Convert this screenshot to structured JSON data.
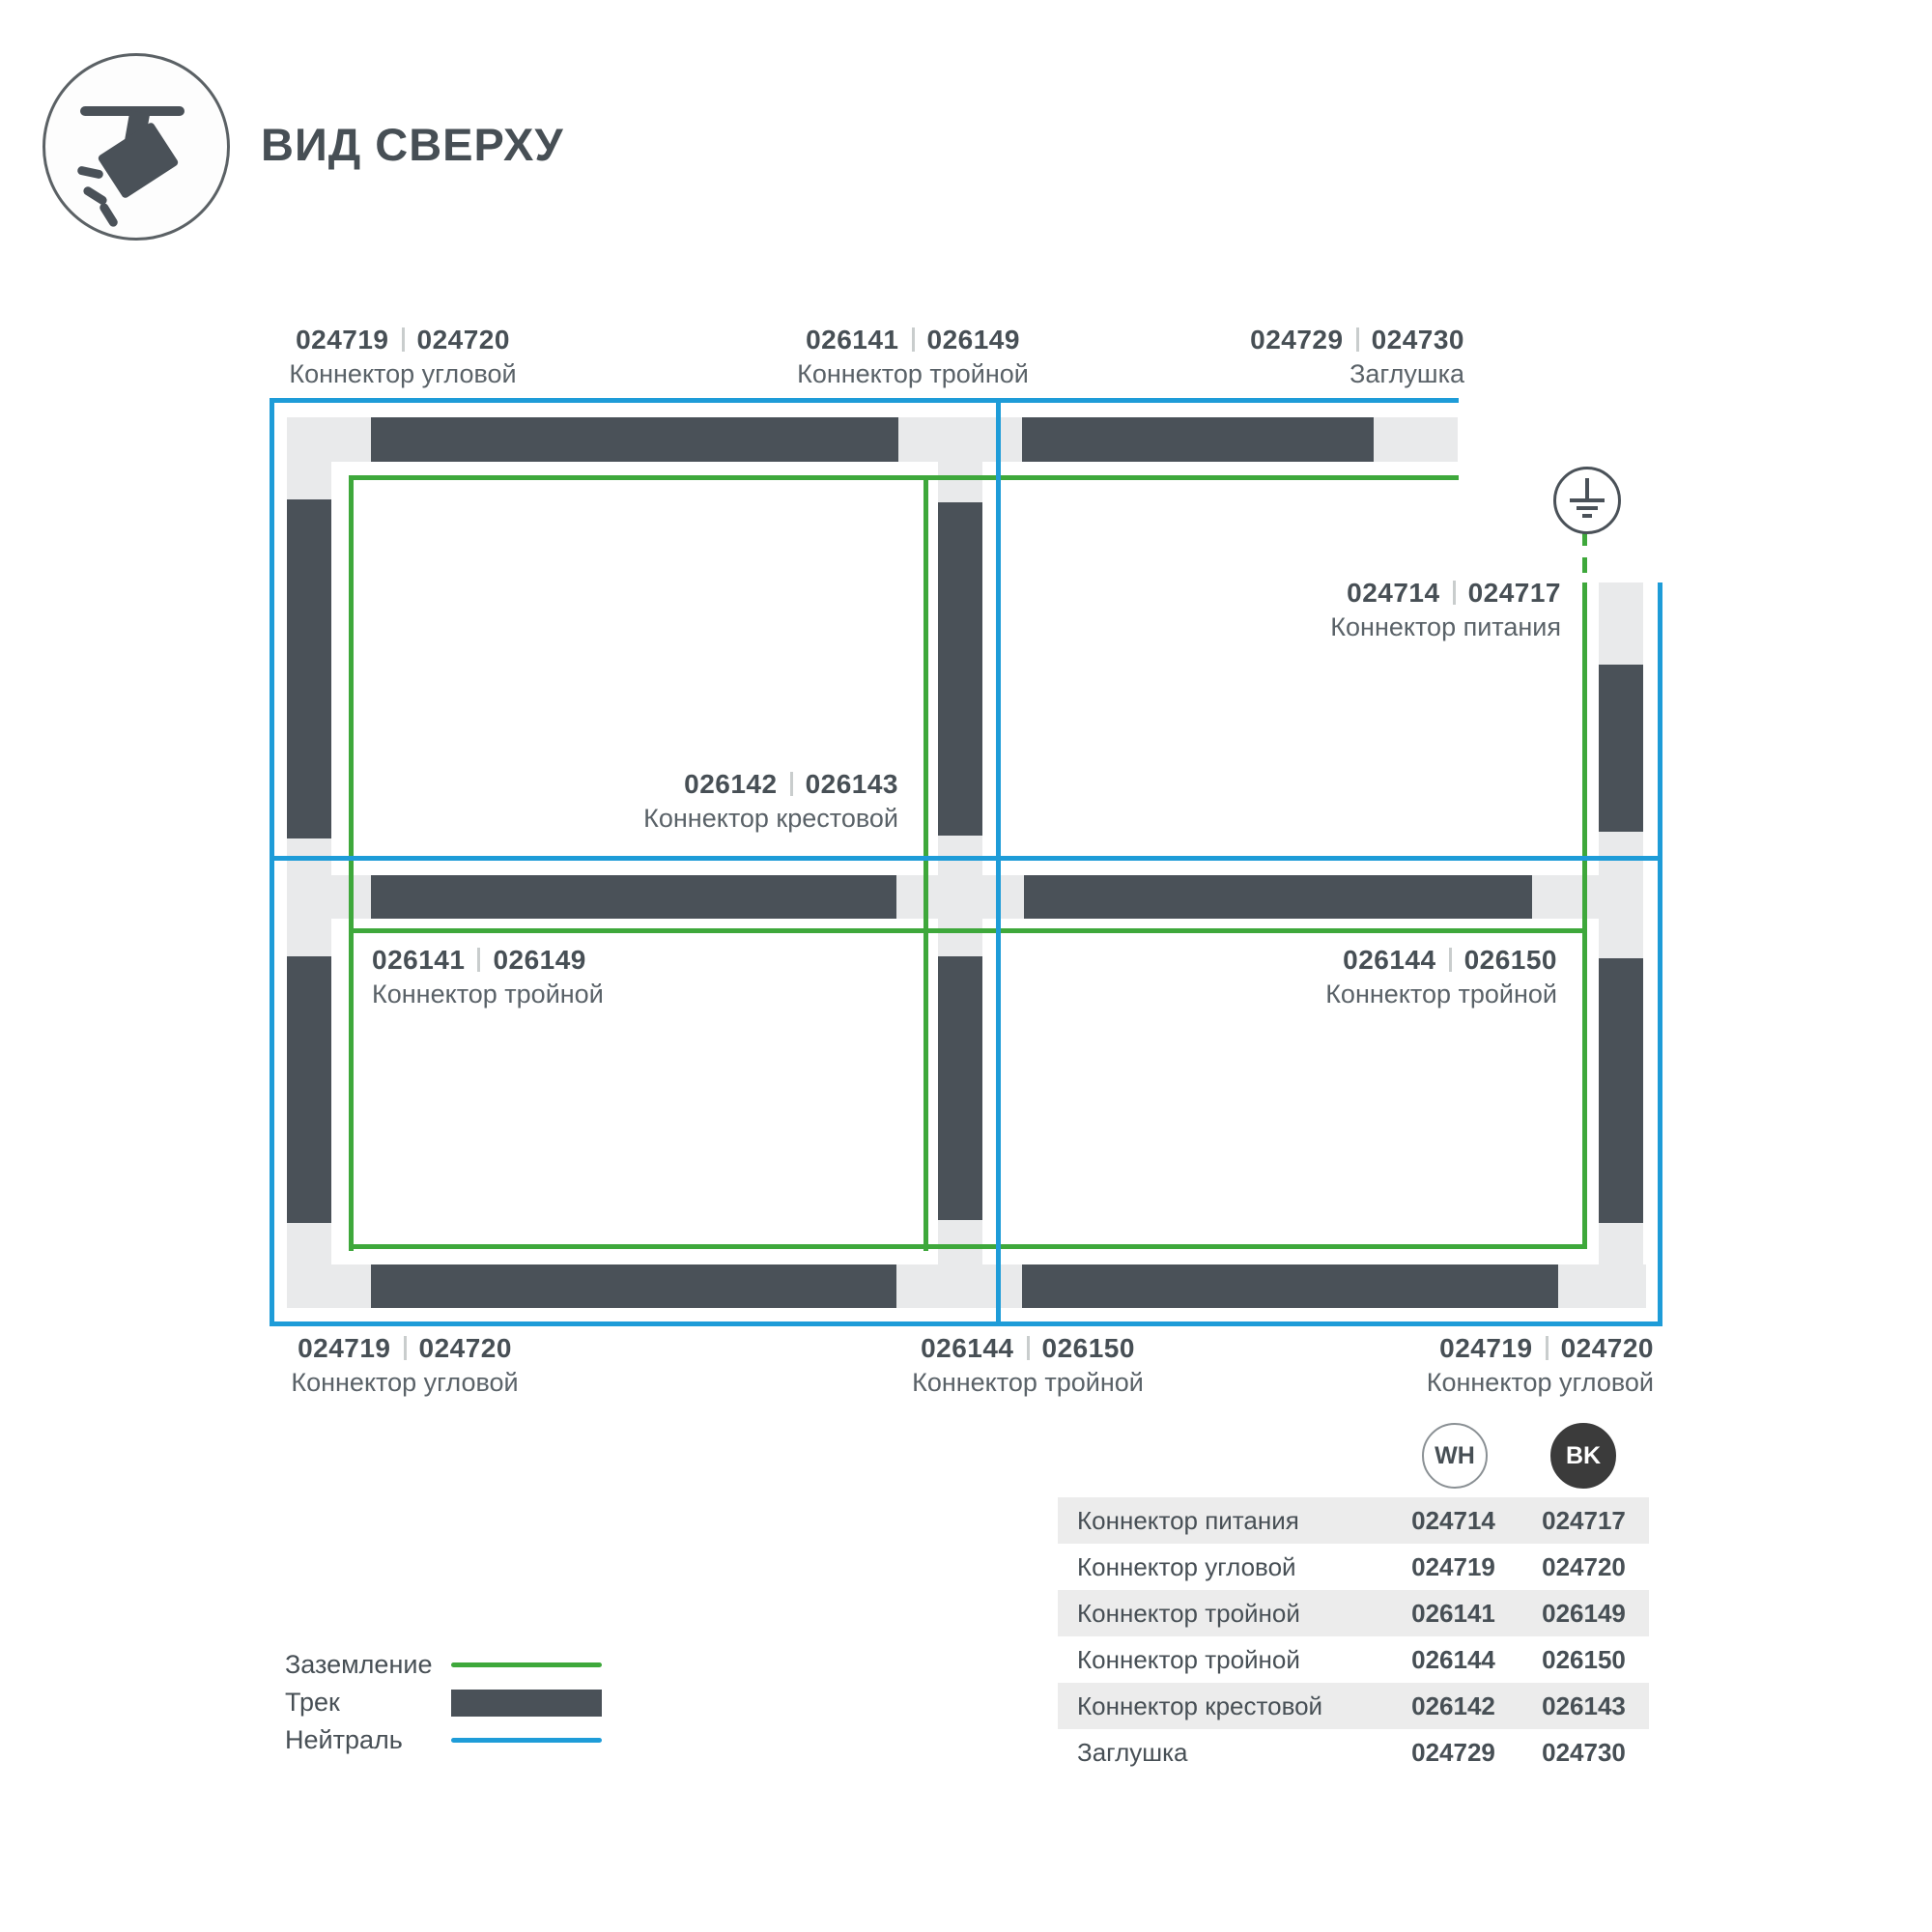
{
  "header": {
    "title": "ВИД СВЕРХУ"
  },
  "icons": {
    "track_light_icon": "track-spotlight",
    "ground_icon": "earth-ground-symbol"
  },
  "colors": {
    "ground_green": "#3ea83b",
    "neutral_blue": "#1e9cd8",
    "track_dark": "#4a5158",
    "track_light": "#e9eaeb",
    "table_row_gray": "#ececec",
    "badge_black": "#3b3b3b"
  },
  "labels": {
    "top_left": {
      "wh": "024719",
      "bk": "024720",
      "name": "Коннектор угловой"
    },
    "top_middle": {
      "wh": "026141",
      "bk": "026149",
      "name": "Коннектор тройной"
    },
    "top_right": {
      "wh": "024729",
      "bk": "024730",
      "name": "Заглушка"
    },
    "power": {
      "wh": "024714",
      "bk": "024717",
      "name": "Коннектор питания"
    },
    "center_cross": {
      "wh": "026142",
      "bk": "026143",
      "name": "Коннектор крестовой"
    },
    "middle_left": {
      "wh": "026141",
      "bk": "026149",
      "name": "Коннектор тройной"
    },
    "middle_right": {
      "wh": "026144",
      "bk": "026150",
      "name": "Коннектор тройной"
    },
    "bottom_left": {
      "wh": "024719",
      "bk": "024720",
      "name": "Коннектор угловой"
    },
    "bottom_middle": {
      "wh": "026144",
      "bk": "026150",
      "name": "Коннектор тройной"
    },
    "bottom_right": {
      "wh": "024719",
      "bk": "024720",
      "name": "Коннектор угловой"
    }
  },
  "legend": {
    "items": [
      {
        "label": "Заземление",
        "color": "#3ea83b",
        "style": "line"
      },
      {
        "label": "Трек",
        "color": "#4a5158",
        "style": "bar"
      },
      {
        "label": "Нейтраль",
        "color": "#1e9cd8",
        "style": "line"
      }
    ]
  },
  "badges": {
    "wh": "WH",
    "bk": "BK"
  },
  "table": {
    "rows": [
      {
        "name": "Коннектор питания",
        "wh": "024714",
        "bk": "024717"
      },
      {
        "name": "Коннектор угловой",
        "wh": "024719",
        "bk": "024720"
      },
      {
        "name": "Коннектор тройной",
        "wh": "026141",
        "bk": "026149"
      },
      {
        "name": "Коннектор тройной",
        "wh": "026144",
        "bk": "026150"
      },
      {
        "name": "Коннектор крестовой",
        "wh": "026142",
        "bk": "026143"
      },
      {
        "name": "Заглушка",
        "wh": "024729",
        "bk": "024730"
      }
    ]
  }
}
